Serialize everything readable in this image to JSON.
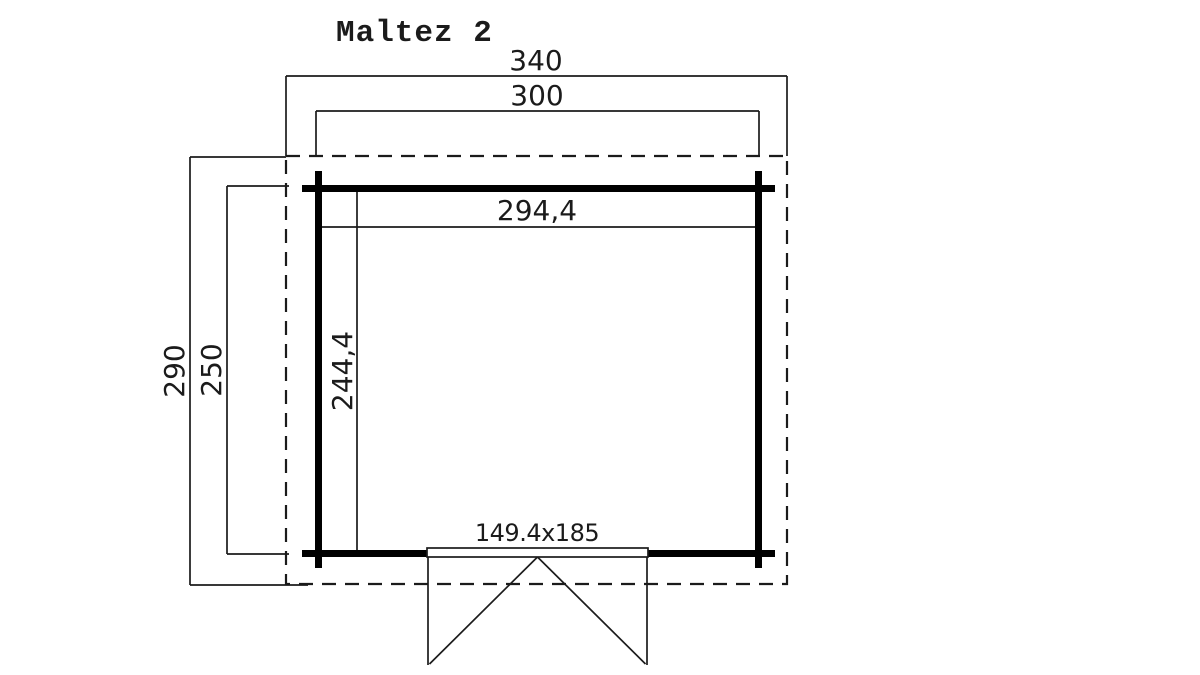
{
  "title": "Maltez 2",
  "dims": {
    "outer_width": "340",
    "overall_width": "300",
    "inner_width": "294,4",
    "outer_depth": "290",
    "overall_depth": "250",
    "inner_depth": "244,4",
    "door": "149.4x185"
  },
  "colors": {
    "line": "#1b1b1b",
    "wall": "#000000",
    "background": "#ffffff"
  }
}
